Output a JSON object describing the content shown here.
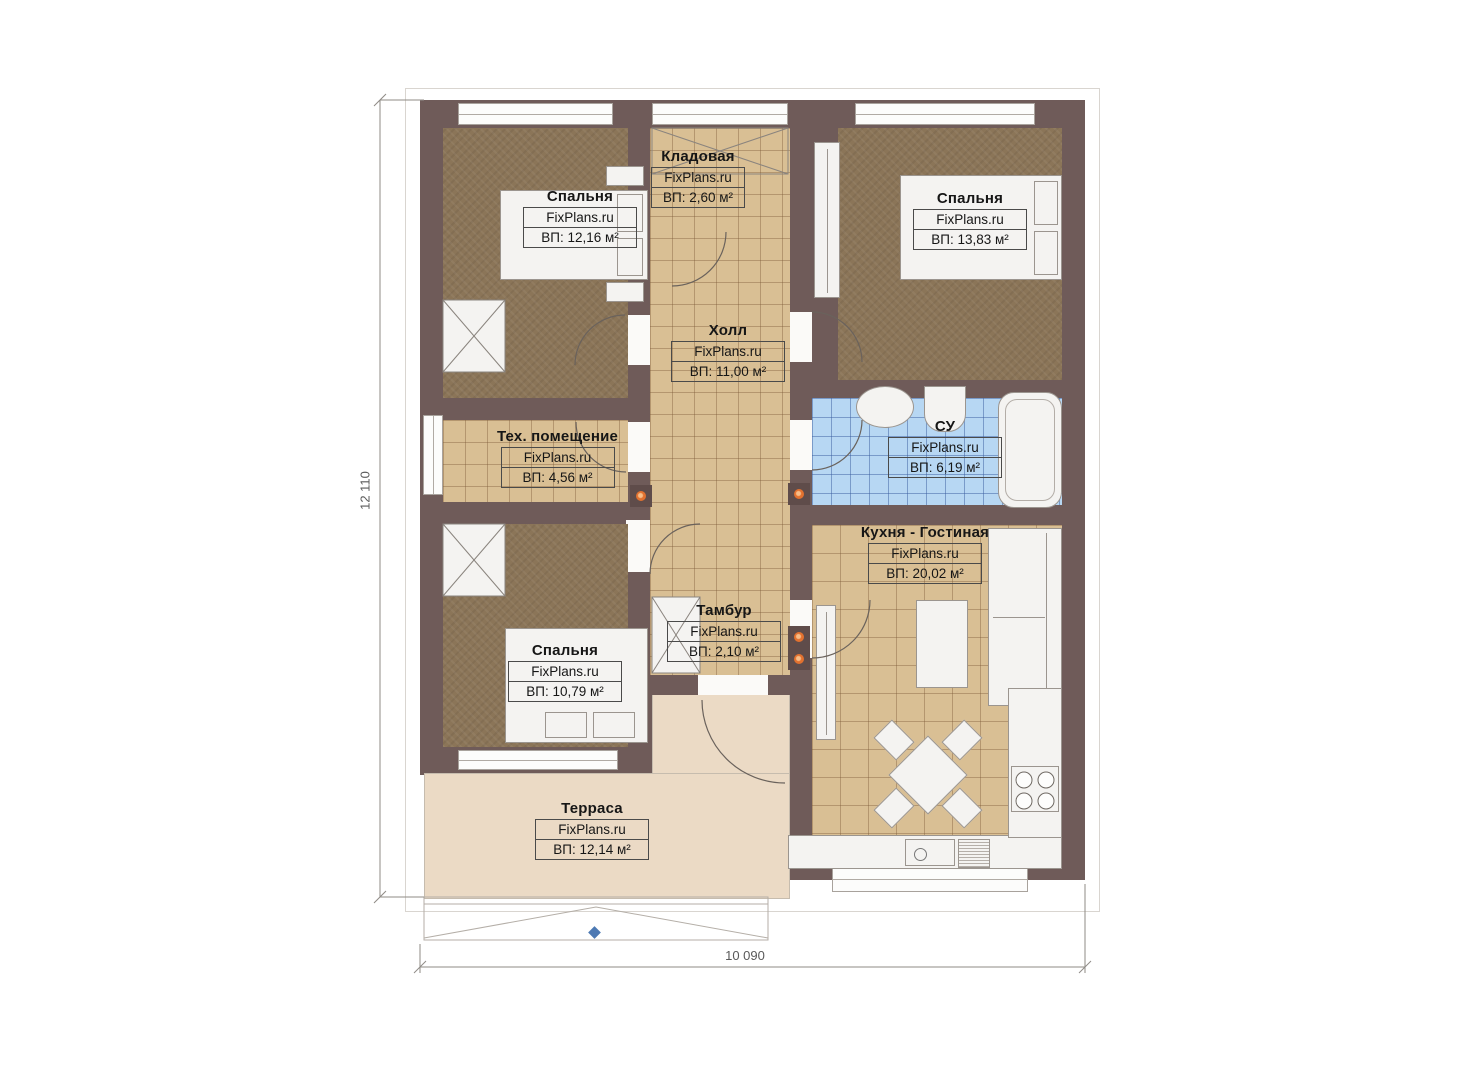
{
  "plan": {
    "title": "Floor plan",
    "watermark": "FixPlans.ru",
    "rooms": [
      {
        "id": "bedroom-1",
        "name": "Спальня",
        "watermark": "FixPlans.ru",
        "area": "ВП: 12,16 м²"
      },
      {
        "id": "storage",
        "name": "Кладовая",
        "watermark": "FixPlans.ru",
        "area": "ВП: 2,60 м²"
      },
      {
        "id": "bedroom-2",
        "name": "Спальня",
        "watermark": "FixPlans.ru",
        "area": "ВП: 13,83 м²"
      },
      {
        "id": "hall",
        "name": "Холл",
        "watermark": "FixPlans.ru",
        "area": "ВП: 11,00 м²"
      },
      {
        "id": "tech-room",
        "name": "Тех. помещение",
        "watermark": "FixPlans.ru",
        "area": "ВП: 4,56 м²"
      },
      {
        "id": "bathroom",
        "name": "СУ",
        "watermark": "FixPlans.ru",
        "area": "ВП: 6,19 м²"
      },
      {
        "id": "kitchen-living",
        "name": "Кухня - Гостиная",
        "watermark": "FixPlans.ru",
        "area": "ВП: 20,02 м²"
      },
      {
        "id": "vestibule",
        "name": "Тамбур",
        "watermark": "FixPlans.ru",
        "area": "ВП: 2,10 м²"
      },
      {
        "id": "bedroom-3",
        "name": "Спальня",
        "watermark": "FixPlans.ru",
        "area": "ВП: 10,79 м²"
      },
      {
        "id": "terrace",
        "name": "Терраса",
        "watermark": "FixPlans.ru",
        "area": "ВП: 12,14 м²"
      }
    ],
    "dimensions": {
      "vertical": "12 110",
      "horizontal": "10 090"
    },
    "colors": {
      "wall": "#6f5b59",
      "carpet": "#8b7558",
      "tile": "#d9bf94",
      "bath_tile": "#b7d7f3",
      "terrace": "#ebdac5",
      "fixture": "#f4f3f1",
      "accent_dot": "#e2712f",
      "entrance_marker": "#4d79b3"
    }
  }
}
